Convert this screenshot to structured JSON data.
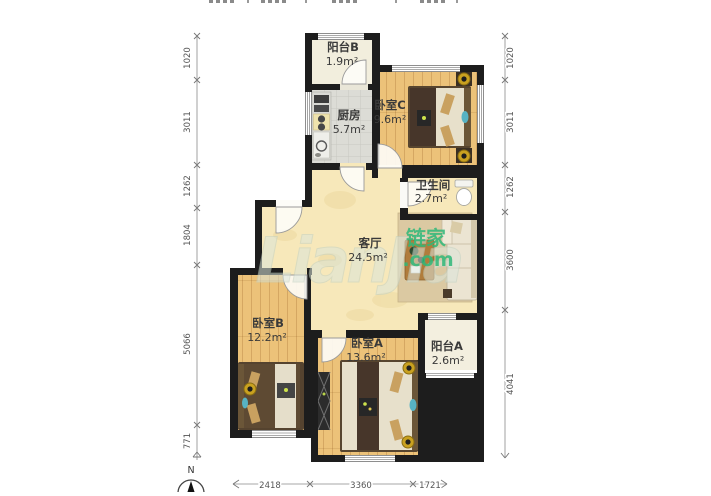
{
  "rooms": [
    {
      "id": "balcony-b",
      "name": "阳台B",
      "area": "1.9m²"
    },
    {
      "id": "kitchen",
      "name": "厨房",
      "area": "5.7m²"
    },
    {
      "id": "bedroom-c",
      "name": "卧室C",
      "area": "9.6m²"
    },
    {
      "id": "bathroom",
      "name": "卫生间",
      "area": "2.7m²"
    },
    {
      "id": "living-room",
      "name": "客厅",
      "area": "24.5m²"
    },
    {
      "id": "bedroom-b",
      "name": "卧室B",
      "area": "12.2m²"
    },
    {
      "id": "bedroom-a",
      "name": "卧室A",
      "area": "13.6m²"
    },
    {
      "id": "balcony-a",
      "name": "阳台A",
      "area": "2.6m²"
    }
  ],
  "dimensions": {
    "left": [
      "1020",
      "3011",
      "1262",
      "1804",
      "5066",
      "771"
    ],
    "right": [
      "1020",
      "3011",
      "1262",
      "3600",
      "4041"
    ],
    "bottom": [
      "2418",
      "3360",
      "1721"
    ]
  },
  "watermark": {
    "latin": "LianJia",
    "cn": "链家",
    "tld": ".com"
  },
  "compass": {
    "north": "N"
  },
  "colors": {
    "wall": "#1d1d1d",
    "wood": "#ecc279",
    "living_floor": "#f7e8ba",
    "kitchen_floor": "#dcdcd6",
    "accent_green": "#2fb87a"
  }
}
